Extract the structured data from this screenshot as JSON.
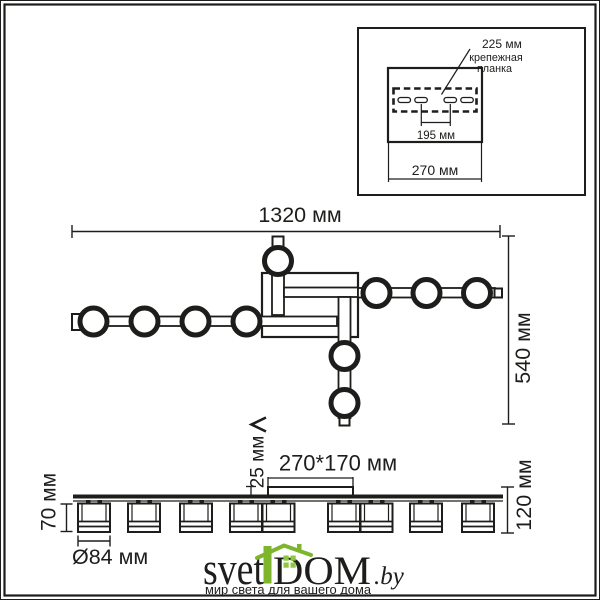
{
  "drawing_title": "ceiling light fixture dimensional drawing",
  "colors": {
    "line": "#1d1d1b",
    "logo_green": "#7db62c",
    "logo_dark": "#3b3b3d",
    "logo_gray": "#8f8f8f",
    "tagline_gray": "#a6a6a6"
  },
  "inset": {
    "dim_plate_width": "225 мм",
    "plank_label_line1": "крепежная",
    "plank_label_line2": "планка",
    "dim_holes_distance": "195 мм",
    "dim_box_width": "270 мм"
  },
  "top_view": {
    "dim_total_width": "1320 мм",
    "dim_total_depth": "540 мм"
  },
  "side_view": {
    "dim_canopy": "270*170 мм",
    "dim_canopy_height": "25 мм",
    "dim_shade_height": "70 мм",
    "dim_fixture_height": "120 мм",
    "dim_shade_diameter": "Ø84 мм"
  },
  "logo": {
    "part1": "svet",
    "part2": "DOM",
    "part3": ".by",
    "tagline": "мир света для вашего дома"
  }
}
